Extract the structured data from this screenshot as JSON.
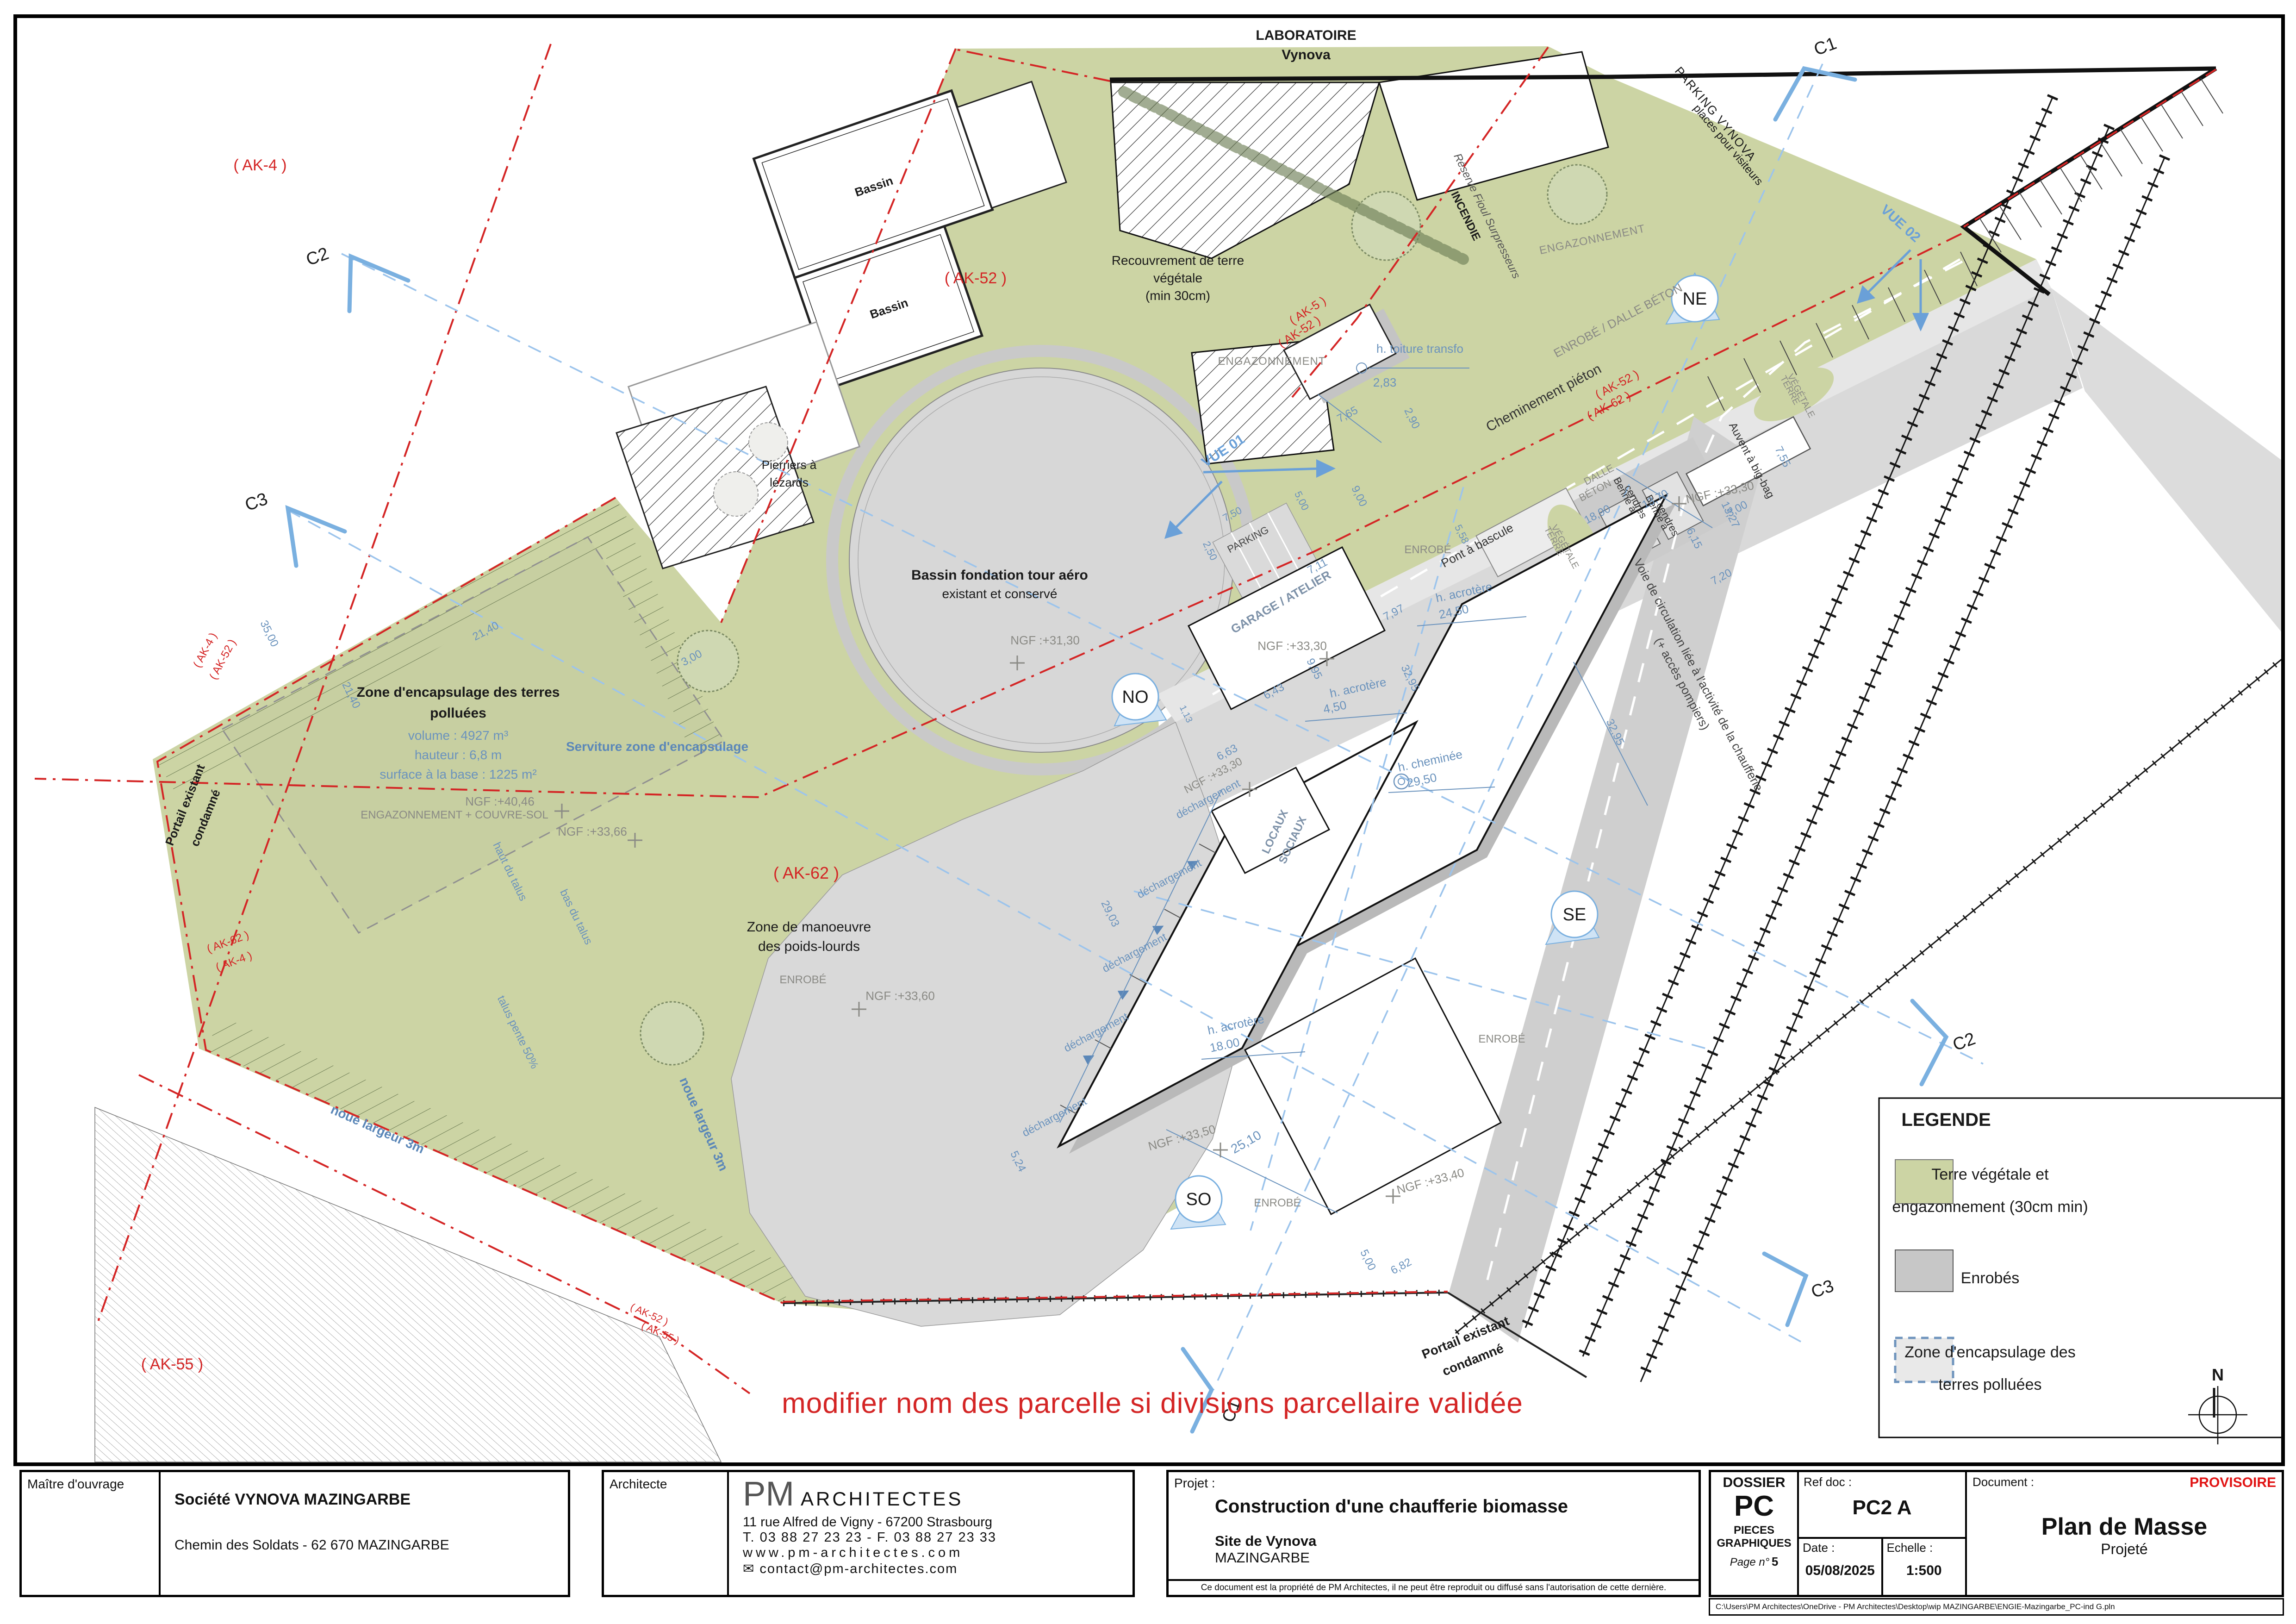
{
  "plan": {
    "labels": {
      "lab1": "LABORATOIRE",
      "lab2": "Vynova",
      "pv1": "PARKING VYNOVA",
      "pv2": "places pour visiteurs",
      "bassin": "Bassin",
      "rec1": "Recouvrement de terre",
      "rec2": "végétale",
      "rec3": "(min 30cm)",
      "engaz": "ENGAZONNEMENT",
      "bf1": "Bassin fondation tour aéro",
      "bf2": "existant et conservé",
      "pier1": "Pierriers à",
      "pier2": "lézards",
      "enc1": "Zone d'encapsulage des terres",
      "enc2": "polluées",
      "encv": "volume : 4927 m³",
      "ench": "hauteur : 6,8 m",
      "encs": "surface à la base : 1225 m²",
      "engcs": "ENGAZONNEMENT + COUVRE-SOL",
      "serv": "Serviture zone d'encapsulage",
      "zm1": "Zone de manoeuvre",
      "zm2": "des poids-lourds",
      "enrobe": "ENROBÉ",
      "enrobe_dalle": "ENROBÉ / DALLE BÉTON",
      "dalle1": "DALLE",
      "dalle2": "BÉTON",
      "chem": "Cheminement piéton",
      "incendie": "INCENDIE",
      "fioul": "Réserve Fioul Surpresseurs",
      "transfo": "h. toiture transfo",
      "transfo_v": "2,83",
      "pont": "Pont à bascule",
      "tv1": "TERRE",
      "tv2": "VÉGÉTALE",
      "auvent": "Auvent à big-bag",
      "benne1": "Benne à",
      "benne2": "cendres",
      "garage": "GARAGE / ATELIER",
      "loc1": "LOCAUX",
      "loc2": "SOCIAUX",
      "voie1": "Voie de circulation liée à l'activité de la chaufferie",
      "voie2": "(+ accès pompiers)",
      "dech": "déchargement",
      "hacr": "h. acrotère",
      "hchem": "h. cheminée",
      "v2450": "24,50",
      "v450": "4,50",
      "v2950": "29,50",
      "v1800": "18.00",
      "por1": "Portail existant",
      "por2": "condamné",
      "noue": "noue largeur 3m",
      "talh": "haut du talus",
      "talb": "bas du talus",
      "talp": "talus pente 50%",
      "parking": "PARKING",
      "vue01": "VUE 01",
      "vue02": "VUE 02",
      "ngf3130": "NGF :+31,30",
      "ngf4046": "NGF :+40,46",
      "ngf3366": "NGF :+33,66",
      "ngf3360": "NGF :+33,60",
      "ngf3330": "NGF :+33,30",
      "ngf3350": "NGF :+33,50",
      "ngf3340": "NGF :+33,40",
      "d3500": "35,00",
      "d2140": "21,40",
      "d300": "3,00",
      "d900": "9,00",
      "d711": "7,11",
      "d797": "7,97",
      "d995": "9,95",
      "d643": "6,43",
      "d3295": "32,95",
      "d2903": "29,03",
      "d524": "5,24",
      "d663": "6,63",
      "d113": "1,13",
      "d1890": "18,90",
      "d1370": "13,70",
      "d1327": "13,27",
      "d615": "6,15",
      "d720": "7,20",
      "d755": "7,55",
      "d558": "5,58",
      "d2510": "25,10",
      "d500": "5,00",
      "d682": "6,82",
      "d765": "7,65",
      "d290": "2,90",
      "d250": "2,50",
      "d750": "7,50",
      "ak4": "( AK-4 )",
      "ak5": "( AK-5 )",
      "ak52": "( AK-52 )",
      "ak55": "( AK-55 )",
      "ak62": "( AK-62 )",
      "no": "NO",
      "ne": "NE",
      "se": "SE",
      "so": "SO",
      "c1": "C1",
      "c2": "C2",
      "c3": "C3",
      "north": "N"
    }
  },
  "note": {
    "text": "modifier nom des parcelle si divisions parcellaire validée"
  },
  "legend": {
    "title": "LEGENDE",
    "items": [
      {
        "color": "#ccd4a4",
        "l1": "Terre végétale et",
        "l2": "engazonnement (30cm min)"
      },
      {
        "color": "#c7c7c7",
        "l1": "Enrobés",
        "l2": ""
      },
      {
        "color": "#e9e9e9",
        "l1": "Zone d'encapsulage des",
        "l2": "terres polluées"
      }
    ]
  },
  "title_block": {
    "owner": {
      "label": "Maître d'ouvrage",
      "name": "Société VYNOVA MAZINGARBE",
      "address": "Chemin des Soldats - 62 670 MAZINGARBE"
    },
    "architect": {
      "label": "Architecte",
      "brand_initials": "PM",
      "brand_rest": "ARCHITECTES",
      "address": "11 rue Alfred de Vigny - 67200 Strasbourg",
      "phone": "T. 03 88 27 23 23 - F. 03 88 27 23 33",
      "website": "www.pm-architectes.com",
      "email_icon": "✉",
      "email": "contact@pm-architectes.com"
    },
    "project": {
      "label": "Projet :",
      "title": "Construction d'une chaufferie biomasse",
      "site": "Site de Vynova",
      "city": "MAZINGARBE",
      "copyright": "Ce document est la propriété de PM Architectes, il ne peut être reproduit ou diffusé sans l'autorisation de cette dernière."
    },
    "dossier": {
      "label": "DOSSIER",
      "code": "PC",
      "sub1": "PIECES",
      "sub2": "GRAPHIQUES",
      "page_label": "Page n°",
      "page": "5"
    },
    "refdoc": {
      "label": "Ref doc :",
      "value": "PC2 A",
      "date_label": "Date :",
      "date": "05/08/2025",
      "scale_label": "Echelle :",
      "scale": "1:500"
    },
    "document": {
      "label": "Document :",
      "status": "PROVISOIRE",
      "title": "Plan de Masse",
      "subtitle": "Projeté",
      "file_path": "C:\\Users\\PM Architectes\\OneDrive - PM Architectes\\Desktop\\wip MAZINGARBE\\ENGIE-Mazingarbe_PC-ind G.pln"
    }
  }
}
